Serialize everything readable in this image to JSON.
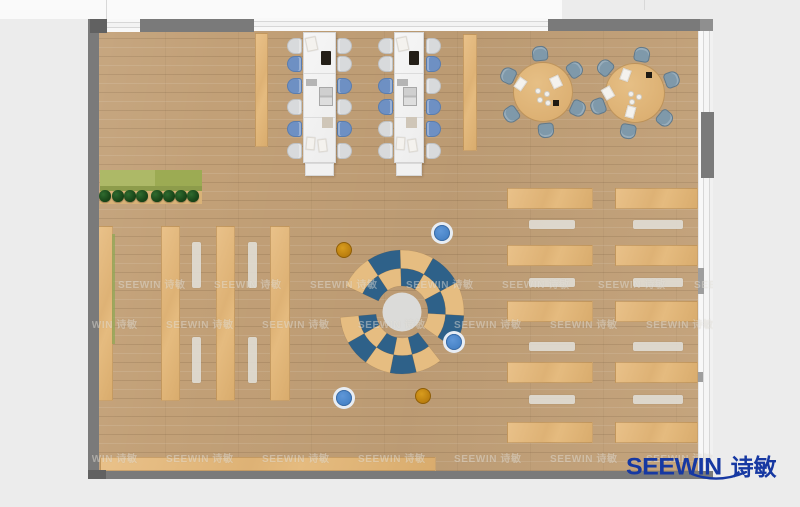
{
  "branding": {
    "logo_text_en": "SEEWIN",
    "logo_text_zh": "诗敏",
    "logo_color": "#1638a2",
    "watermark_text": "SEEWIN 诗敏"
  },
  "palette": {
    "floor_wood": "#c2a077",
    "wall_gray": "#7a7a7a",
    "window_white": "#f6f6f6",
    "desk_white": "#f3f3f3",
    "chair_gray": "#d8dadc",
    "chair_blue": "#6e90c3",
    "meeting_chair": "#7f99aa",
    "table_wood": "#dfb679",
    "arc_blue": "#2e6189",
    "arc_wood": "#e6bd81",
    "stool_blue": "#4d89cf",
    "stool_orange": "#c4860f",
    "planter_green": "#a8b45c",
    "plant_dark_green": "#1c4a1c",
    "bench_white": "#dcd9d2",
    "logo_blue": "#1638a2",
    "outside": "#ececec"
  },
  "furniture": {
    "workstations": {
      "count": 2,
      "seats_per_desk": 12,
      "chair_colors": {
        "desk1_left": [
          "gray",
          "blue",
          "blue",
          "gray",
          "blue",
          "gray"
        ],
        "desk1_right": [
          "gray",
          "gray",
          "blue",
          "gray",
          "blue",
          "gray"
        ],
        "desk2_left": [
          "gray",
          "gray",
          "blue",
          "blue",
          "gray",
          "gray"
        ],
        "desk2_right": [
          "gray",
          "blue",
          "gray",
          "blue",
          "blue",
          "gray"
        ]
      }
    },
    "round_meeting_tables": {
      "count": 2,
      "chairs_each": 6
    },
    "reading_tables_left_columns": 4,
    "reading_tables_right": {
      "rows": 5,
      "columns": 2,
      "benches": 4
    },
    "lounge_circle": {
      "rings": 2,
      "arc_sections": 2,
      "segment_colors": [
        "wood",
        "blue"
      ]
    },
    "stools": {
      "blue": 3,
      "orange": 2
    },
    "planter_plants": 8,
    "wall_cabinets": 2
  }
}
